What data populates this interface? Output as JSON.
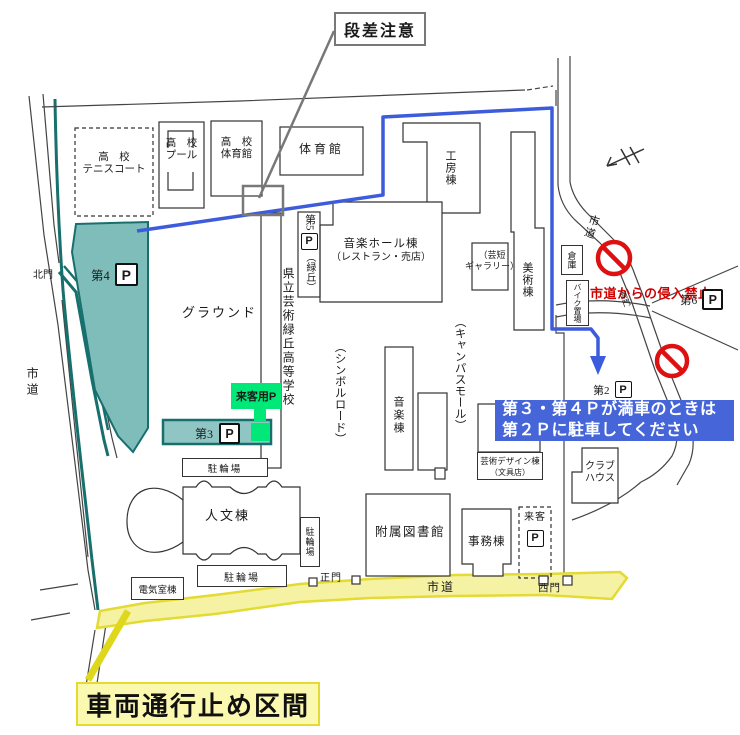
{
  "colors": {
    "teal_fill": "#7fbdba",
    "teal_border": "#17706e",
    "visitor_green": "#00e878",
    "route_blue": "#3c5cdc",
    "notice_blue_bg": "#4565d9",
    "warning_red": "#cf0000",
    "road_yellow_fill": "#f5f2a3",
    "road_yellow_border": "#e3da33",
    "closure_label_bg": "#fbf8b0"
  },
  "annotations": {
    "step_warning": "段差注意",
    "no_entry_from_city_road": "市道からの侵入禁止",
    "parking_full_notice_line1": "第３・第４Ｐが満車のときは",
    "parking_full_notice_line2": "第２Ｐに駐車してください",
    "road_closure": "車両通行止め区間"
  },
  "parking": {
    "p_symbol": "P",
    "lot4_label": "第4",
    "lot3_label": "第3",
    "lot2_label": "第2",
    "lot5_label": "第5",
    "lot5_note": "（緑丘）",
    "lot6_label": "第6",
    "visitor_parking_label": "来客用P",
    "visitor_label": "来客"
  },
  "buildings": {
    "hs_tennis_line1": "高　校",
    "hs_tennis_line2": "テニスコート",
    "hs_pool_line1": "高　校",
    "hs_pool_line2": "プール",
    "hs_gym_line1": "高　校",
    "hs_gym_line2": "体育館",
    "gym": "体育館",
    "workshop": "工房棟",
    "music_hall_line1": "音楽ホール棟",
    "music_hall_line2": "（レストラン・売店）",
    "gallery_line1": "（芸短",
    "gallery_line2": "ギャラリー）",
    "art_building": "美術棟",
    "storage": "倉庫",
    "bike_parking": "バイク置場",
    "high_school": "県立芸術緑丘高等学校",
    "ground": "グラウンド",
    "symbol_road": "（シンボルロード）",
    "campus_mall": "（キャンパスモール）",
    "music_building": "音楽棟",
    "design_building_line1": "芸術デザイン棟",
    "design_building_line2": "（文具店）",
    "club_house_line1": "クラブ",
    "club_house_line2": "ハウス",
    "humanities": "人文棟",
    "library": "附属図書館",
    "admin": "事務棟",
    "electrical": "電気室棟",
    "bicycle_1": "駐輪場",
    "bicycle_2": "駐輪場",
    "bicycle_3": "駐輪場"
  },
  "roads": {
    "city_road_left": "市道",
    "city_road_right": "市道",
    "city_road_bottom": "市道"
  },
  "gates": {
    "north": "北門",
    "south": "南門",
    "main": "正門",
    "west": "西門"
  }
}
